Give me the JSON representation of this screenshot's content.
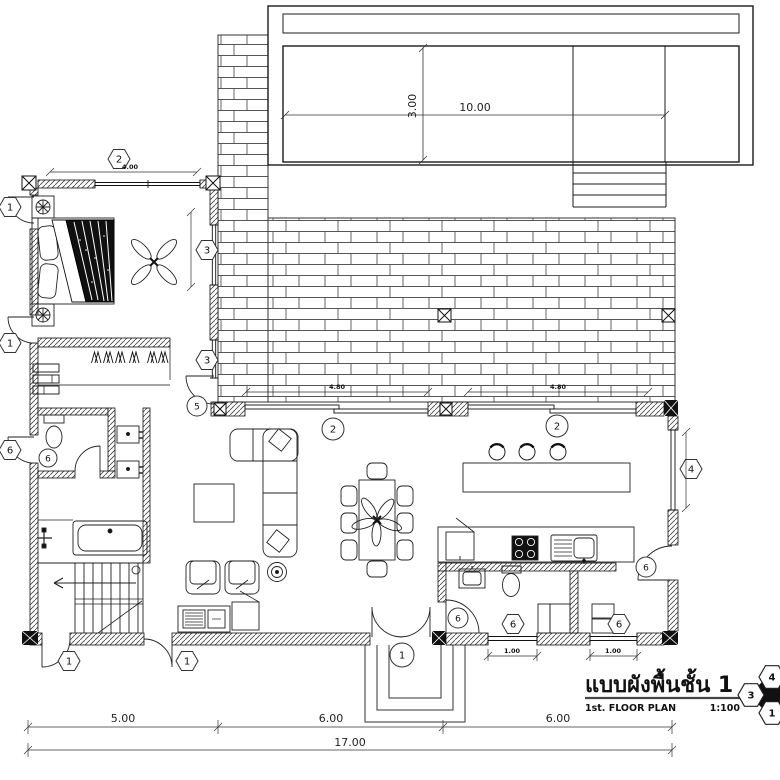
{
  "drawing": {
    "title_thai": "แบบผังพื้นชั้น 1",
    "title_en": "1st. FLOOR PLAN",
    "scale_label": "1:100"
  },
  "dims": {
    "pool_length": "10.00",
    "pool_width": "3.00",
    "bedroom_window": "4.00",
    "terrace_door_1": "4.80",
    "terrace_door_2": "4.80",
    "bath_window": "1.00",
    "store_window": "1.00",
    "bay_1": "5.00",
    "bay_2": "6.00",
    "bay_3": "6.00",
    "total_width": "17.00"
  },
  "tags": {
    "door_bedroom_ext": "1",
    "door_hall_ext": "1",
    "door_stair_ext": "1",
    "door_living_ext": "1",
    "entry_door": "1",
    "window_bedroom": "2",
    "axis_living": "2",
    "axis_kitchen": "2",
    "window_bedroom_side": "3",
    "window_closet": "3",
    "window_east": "4",
    "door_terrace": "5",
    "door_wc_ext": "6",
    "door_wc": "6",
    "door_bath": "6",
    "door_store": "6",
    "window_bath": "6",
    "window_store": "6"
  },
  "keyplan": {
    "elev_3": "3",
    "elev_4": "4",
    "elev_1": "1"
  }
}
